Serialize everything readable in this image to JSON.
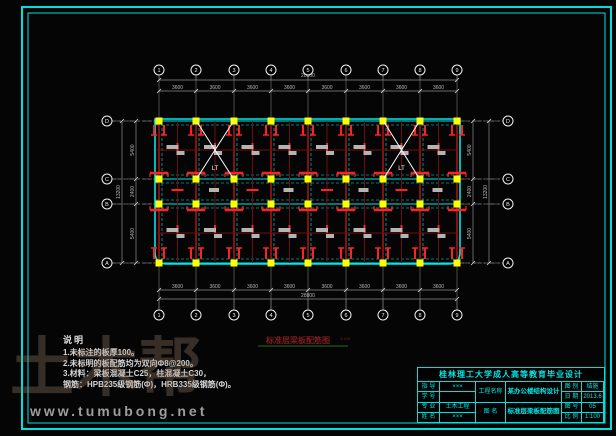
{
  "colors": {
    "frame": "#00e0e0",
    "grid": "#8f8f8f",
    "dim_text": "#b8b8b8",
    "bubble": "#f2f2f2",
    "beam_dark": "#8f1414",
    "beam_dark2": "#6e0f0f",
    "rebar": "#ff2020",
    "slab_cyan": "#00e8e8",
    "column_yellow": "#ffff00",
    "stair_white": "#ffffff",
    "caption": "#7d1d1d",
    "caption_line": "#1d6e1d",
    "gray_label": "#b4b4b4"
  },
  "plan": {
    "type": "structural-floor-plan",
    "axes_x": [
      159,
      196,
      234,
      271,
      308,
      346,
      383,
      420,
      457
    ],
    "axis_labels": [
      "1",
      "2",
      "3",
      "4",
      "5",
      "6",
      "7",
      "8",
      "9"
    ],
    "rows_y": [
      121,
      179,
      204,
      263
    ],
    "row_labels": [
      "D",
      "C",
      "B",
      "A"
    ],
    "outline": {
      "x1": 155,
      "y1": 119,
      "x2": 460,
      "y2": 264,
      "corner_r": 12
    },
    "bubbles": {
      "top_y": 70,
      "bottom_y": 315,
      "left_x": 107,
      "right_x": 508,
      "r": 5
    },
    "mid_beams_y": [
      150,
      233
    ],
    "stairs": [
      {
        "x1": 197,
        "y1": 122,
        "x2": 233,
        "y2": 178,
        "label": "LT"
      },
      {
        "x1": 384,
        "y1": 122,
        "x2": 419,
        "y2": 178,
        "label": "LT"
      }
    ],
    "dimensions": {
      "top": {
        "overall": "28800",
        "spans": [
          "3600",
          "3600",
          "3600",
          "3600",
          "3600",
          "3600",
          "3600",
          "3600"
        ]
      },
      "bottom": {
        "overall": "28800",
        "spans": [
          "3600",
          "3600",
          "3600",
          "3600",
          "3600",
          "3600",
          "3600",
          "3600"
        ]
      },
      "left": {
        "overall": "13200",
        "spans": [
          "5400",
          "2400",
          "5400"
        ]
      },
      "right": {
        "overall": "13200",
        "spans": [
          "5400",
          "2400",
          "5400"
        ]
      }
    },
    "caption": {
      "text": "标准层梁板配筋图",
      "scale": "1:100"
    },
    "slab_label_text": "Φ8@200"
  },
  "notes": {
    "heading": "说明",
    "lines": [
      "1.未标注的板厚100。",
      "2.未标明的板配筋均为双向Φ8@200。",
      "3.材料：梁板混凝土C25，柱混凝土C30，",
      "  钢筋：HPB235级钢筋(Φ)，HRB335级钢筋(Φ)。"
    ]
  },
  "title_block": {
    "title": "桂林理工大学成人高等教育毕业设计",
    "left": [
      {
        "label": "指 导",
        "value": "×××"
      },
      {
        "label": "学 号",
        "value": ""
      },
      {
        "label": "专 业",
        "value": "土木工程"
      },
      {
        "label": "姓 名",
        "value": "×××"
      }
    ],
    "mid": [
      {
        "label": "工程名称",
        "value": "某办公楼结构设计"
      },
      {
        "label": "图 名",
        "value": "标准层梁板配筋图"
      }
    ],
    "right": [
      {
        "label": "图 别",
        "value": "结施"
      },
      {
        "label": "日 期",
        "value": "2013.6"
      },
      {
        "label": "图 号",
        "value": "05"
      },
      {
        "label": "比 例",
        "value": "1:100"
      }
    ]
  },
  "watermark": {
    "logo_text": "土木帮",
    "url_text": "www.tumubong.net"
  }
}
